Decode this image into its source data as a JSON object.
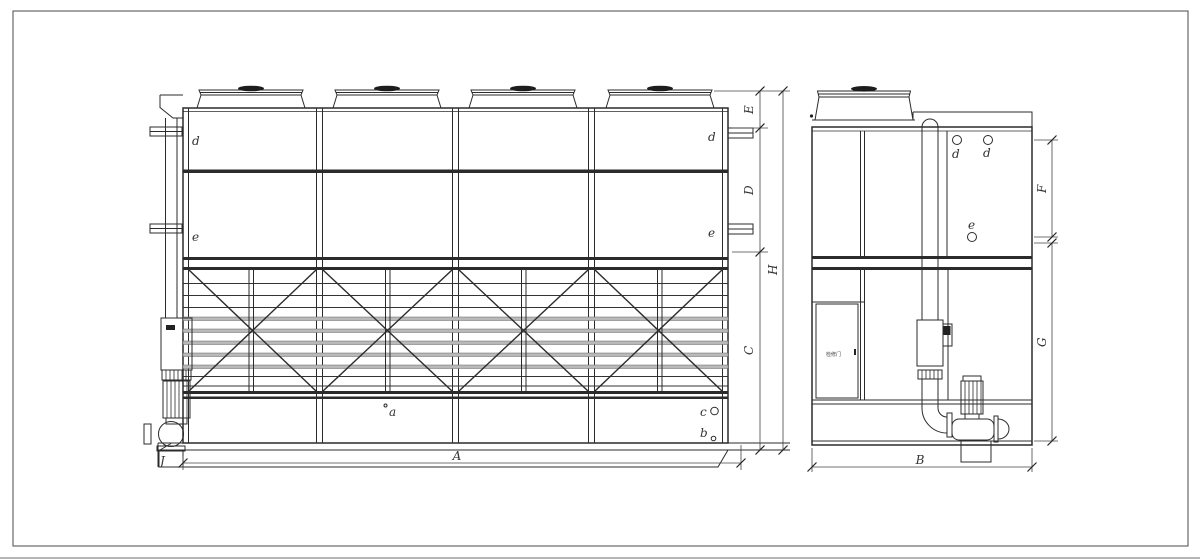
{
  "drawing_labels": {
    "dim_A": "A",
    "dim_B": "B",
    "dim_C": "C",
    "dim_D": "D",
    "dim_E": "E",
    "dim_F": "F",
    "dim_G": "G",
    "dim_H": "H",
    "dim_J": "J",
    "conn_a": "a",
    "conn_b": "b",
    "conn_c": "c",
    "conn_d": "d",
    "conn_e": "e",
    "door_label": "检修门"
  },
  "colors": {
    "line": "#2b2b2b",
    "louver_gray": "#b9b9b9",
    "background": "#ffffff"
  }
}
